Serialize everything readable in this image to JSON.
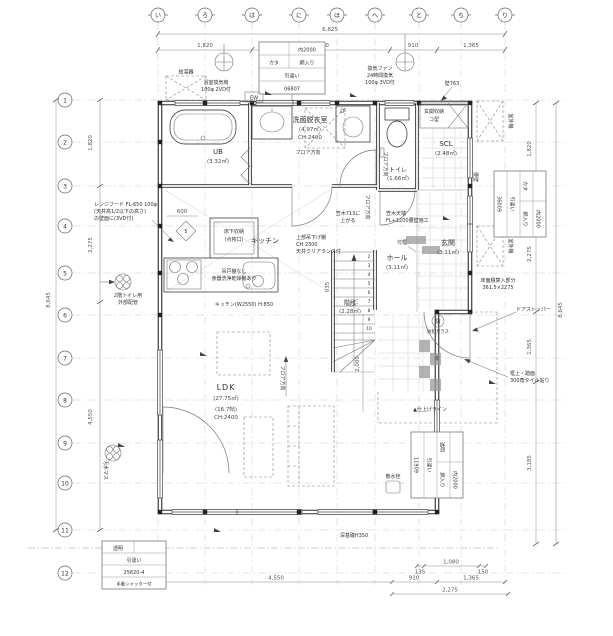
{
  "grid": {
    "cols": [
      "い",
      "ろ",
      "は",
      "に",
      "ほ",
      "へ",
      "と",
      "ち",
      "り"
    ],
    "rows": [
      "1",
      "2",
      "3",
      "4",
      "5",
      "6",
      "7",
      "8",
      "9",
      "10",
      "11",
      "12"
    ]
  },
  "dims": {
    "top_total": "6,825",
    "top1": "1,820",
    "top2": "2,730",
    "top3": "910",
    "top4": "1,365",
    "left1": "1,820",
    "left2": "2,275",
    "left3": "4,550",
    "left_total": "8,645",
    "right1": "1,820",
    "right2": "2,275",
    "right3": "1,365",
    "right4": "3,185",
    "right_total": "8,645",
    "bot_135": "135",
    "bot_1080": "1,080",
    "bot_150": "150",
    "bot1": "4,550",
    "bot2": "910",
    "bot3": "1,365",
    "bot4": "2,275",
    "porch": "2,000",
    "k600": "600",
    "k935": "935"
  },
  "rooms": {
    "ub": {
      "name": "UB",
      "area": "(3.32㎡)"
    },
    "senmen": {
      "name": "洗面脱衣室",
      "area": "(4.97㎡)",
      "ch": "CH:2400"
    },
    "toilet": {
      "name": "トイレ",
      "area": "(1.66㎡)"
    },
    "scl": {
      "name": "SCL",
      "area": "(2.48㎡)"
    },
    "genkan": {
      "name": "玄関",
      "area": "(3.11㎡)"
    },
    "hall": {
      "name": "ホール",
      "area": "(3.11㎡)"
    },
    "stairs": {
      "name": "階段",
      "area": "(2.28㎡)"
    },
    "kitchen": {
      "name": "キッチン"
    },
    "ldk": {
      "name": "LDK",
      "area": "(27.75㎡)",
      "tatami": "(16.7帖)",
      "ch": "CH:2400"
    }
  },
  "notes": {
    "bath_fan1": "浴室換気扇",
    "bath_fan2": "100φ 2VD付",
    "kyutoki": "給湯器",
    "ew": "EW",
    "ep": "EP",
    "kanki1": "換気ファン",
    "kanki2": "24時間換気",
    "kanki3": "100φ 3VD付",
    "kabe763": "壁763",
    "shuno1": "玄関収納",
    "shuno2": "コ型",
    "soto": "室外機",
    "koshikabe": "腰壁",
    "range1": "レンジフード FL-650 100φ",
    "range2": "(天井高1/2以下の高さ)",
    "range3": "の壁面に(3VD付)",
    "tsurido1": "吊戸棚なし",
    "tsurido2": "食器洗浄乾燥機あり",
    "yukashita1": "床下収納",
    "yukashita2": "(点検口)",
    "uwabu1": "上部吊下げ棚",
    "uwabu2": "CH 2300",
    "uwabu3": "天井クリアランス付",
    "floor_dir": "フロア方向",
    "tsukegamachi": "付框",
    "kasagi1": "笠木天端",
    "kasagi2": "FL+1200腰壁施工",
    "agaru1": "笠木713に",
    "agaru2": "上がる",
    "menseki1": "床面積算入部分",
    "menseki2": "361.5×2275",
    "doorstop": "ドアストッパー",
    "tile1": "框上・踏面",
    "tile2": "300角タイル貼り",
    "bouhan_mark": "防",
    "bouhan": "防犯ガラス",
    "sansui": "散水栓",
    "shiage": "▲仕上げライン",
    "fukiso": "深基礎H350",
    "haikan1": "2階トイレ用",
    "haikan2": "外部配管",
    "kitchen_spec": "キッチン(W2550) H:850",
    "osui": "汚水マス",
    "diamond": "5"
  },
  "schedules": {
    "top": {
      "size": "内2000",
      "glass1": "カタ",
      "glass2": "網入り",
      "type": "引違い",
      "code": "06807"
    },
    "right": {
      "size": "内2000",
      "glass1": "カタ",
      "glass2": "網入り",
      "type": "引違い",
      "code": "36009"
    },
    "bottom": {
      "size": "内2000",
      "glass1": "透明",
      "glass2": "網入り",
      "type": "引違い",
      "code": "11909"
    },
    "left": {
      "glass": "透明",
      "type": "引違い",
      "code": "25620-4",
      "shutter": "手動シャッター付"
    }
  },
  "stair_steps": [
    "2",
    "3",
    "4",
    "5",
    "6",
    "7",
    "8",
    "9",
    "10"
  ]
}
